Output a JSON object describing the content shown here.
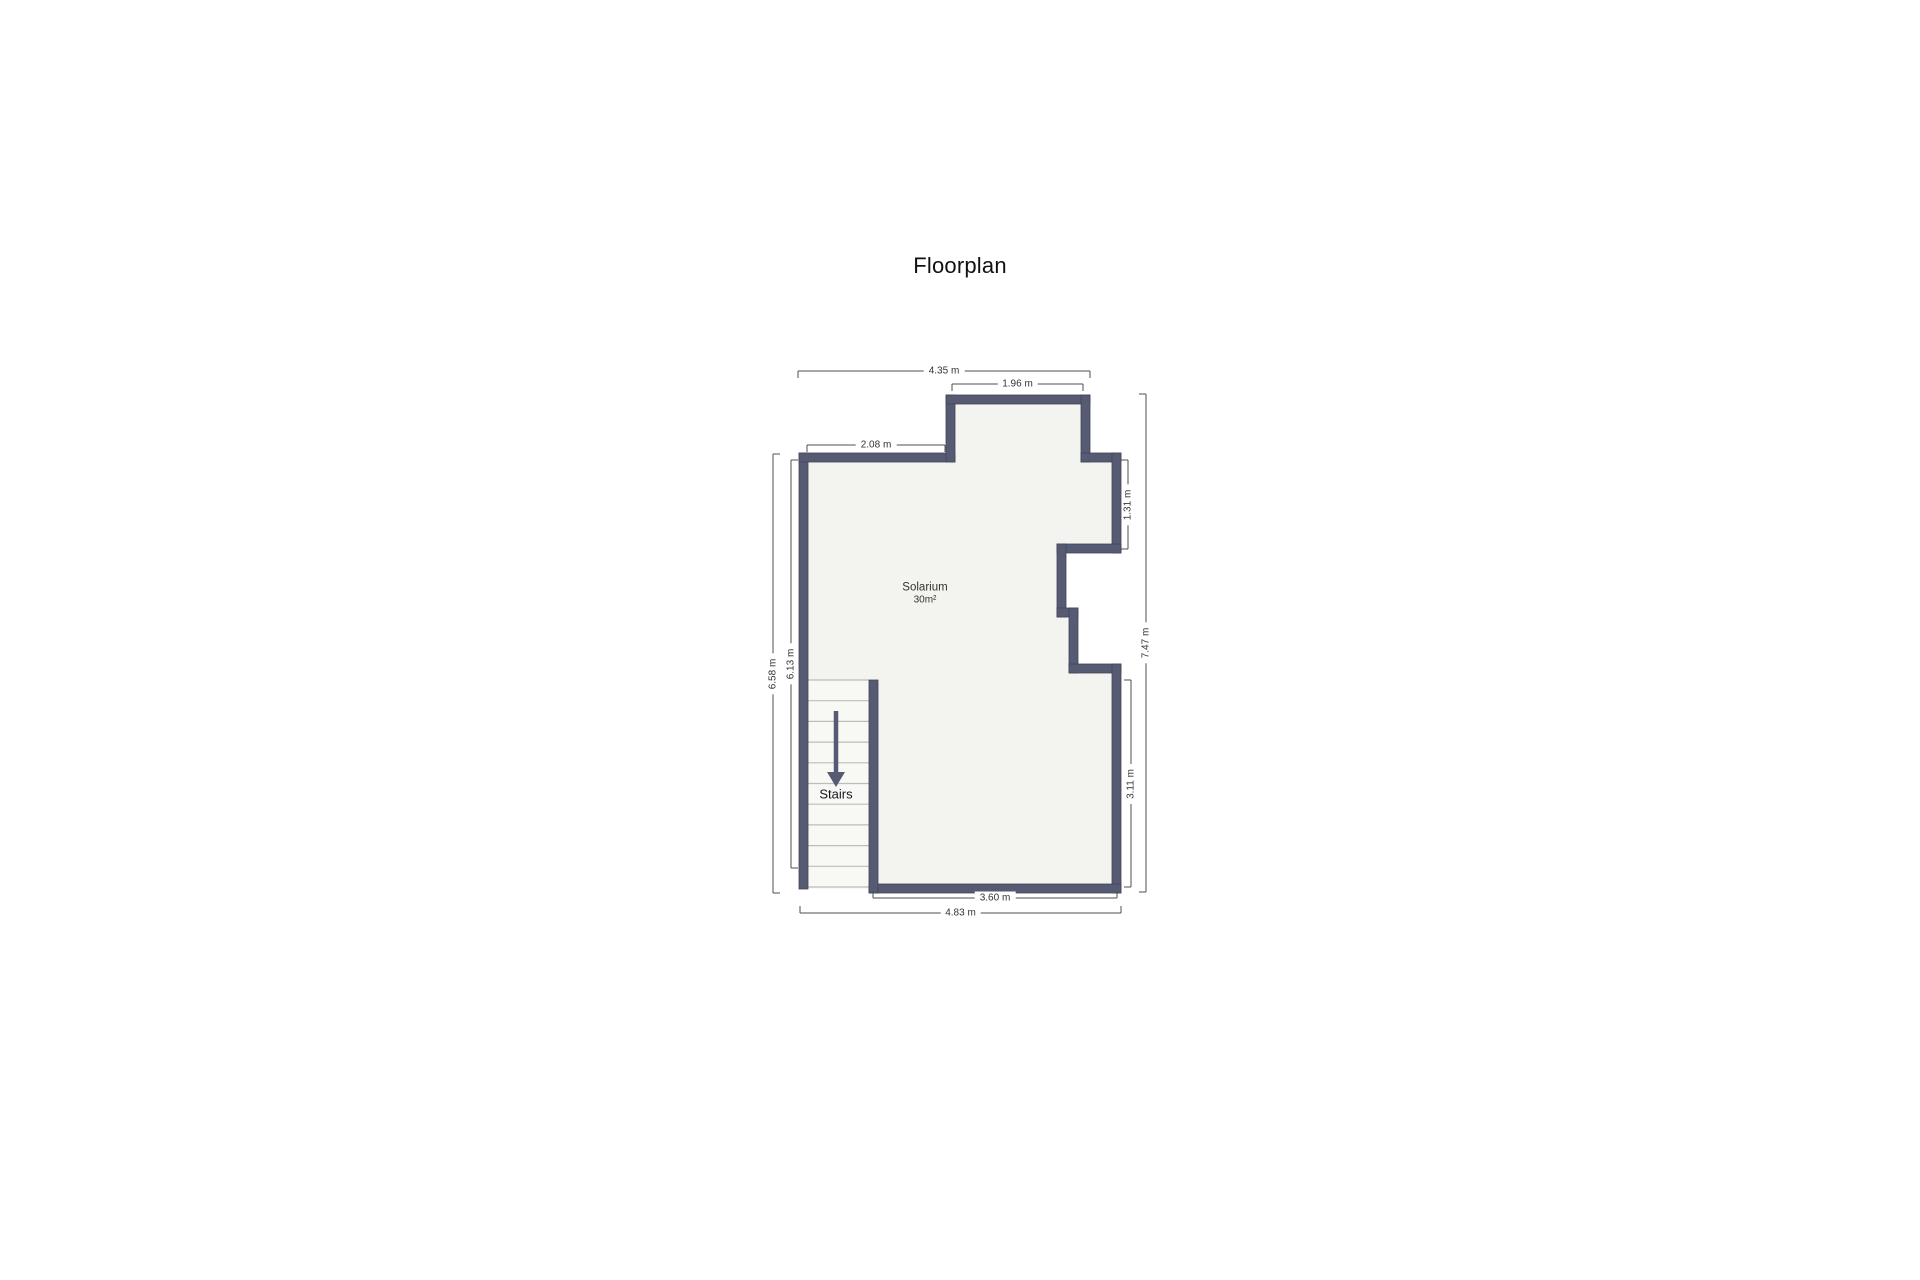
{
  "page": {
    "title": "Floorplan",
    "background": "#ffffff"
  },
  "room": {
    "name": "Solarium",
    "area": "30m²"
  },
  "stairs": {
    "label": "Stairs"
  },
  "colors": {
    "wall": "#565b73",
    "wall_outline": "#41465a",
    "floor": "#f3f3f0",
    "stairwell": "#f8f8f5",
    "tread": "#bcbcbc",
    "dim_line": "#4f4f4f",
    "arrow": "#565b73"
  },
  "floorplan": {
    "floor_polygon": "799,453 946,453 946,395 1090,395 1090,453 1121,453 1121,553 1066,553 1066,608 1078,608 1078,664 1121,664 1121,893 869,893 869,889 799,889",
    "stairwell_rect": {
      "x": 808,
      "y": 680,
      "w": 61,
      "h": 209
    },
    "walls": [
      {
        "name": "wall-left",
        "x": 799,
        "y": 453,
        "w": 9,
        "h": 436
      },
      {
        "name": "wall-top",
        "x": 799,
        "y": 453,
        "w": 156,
        "h": 9
      },
      {
        "name": "wall-bump-left",
        "x": 946,
        "y": 395,
        "w": 9,
        "h": 67
      },
      {
        "name": "wall-bump-top",
        "x": 946,
        "y": 395,
        "w": 144,
        "h": 9
      },
      {
        "name": "wall-bump-right",
        "x": 1081,
        "y": 395,
        "w": 9,
        "h": 67
      },
      {
        "name": "wall-top-right-step",
        "x": 1081,
        "y": 453,
        "w": 40,
        "h": 9
      },
      {
        "name": "wall-right-upper",
        "x": 1112,
        "y": 453,
        "w": 9,
        "h": 100
      },
      {
        "name": "wall-notch-top",
        "x": 1057,
        "y": 544,
        "w": 64,
        "h": 9
      },
      {
        "name": "wall-notch-left-upper",
        "x": 1057,
        "y": 544,
        "w": 9,
        "h": 73
      },
      {
        "name": "wall-notch-step",
        "x": 1057,
        "y": 608,
        "w": 21,
        "h": 9
      },
      {
        "name": "wall-notch-left-lower",
        "x": 1069,
        "y": 608,
        "w": 9,
        "h": 65
      },
      {
        "name": "wall-notch-bottom",
        "x": 1069,
        "y": 664,
        "w": 52,
        "h": 9
      },
      {
        "name": "wall-right-lower",
        "x": 1112,
        "y": 664,
        "w": 9,
        "h": 229
      },
      {
        "name": "wall-bottom",
        "x": 869,
        "y": 884,
        "w": 252,
        "h": 9
      },
      {
        "name": "wall-stairs-right",
        "x": 869,
        "y": 680,
        "w": 9,
        "h": 213
      }
    ],
    "treads": {
      "x1": 808,
      "x2": 869,
      "y_start": 680,
      "y_end": 887,
      "lines": 11
    },
    "arrow": {
      "x": 836,
      "y1": 711,
      "y2": 773,
      "head_half_w": 9,
      "head_len": 14,
      "stroke_w": 4.5
    },
    "room_label_pos": {
      "x": 925,
      "y": 594
    },
    "stairs_label_pos": {
      "x": 836,
      "y": 794
    },
    "dimensions": [
      {
        "label": "4.35 m",
        "orient": "h",
        "x1": 798,
        "x2": 1090,
        "y": 371,
        "tick": "down"
      },
      {
        "label": "1.96 m",
        "orient": "h",
        "x1": 952,
        "x2": 1083,
        "y": 384,
        "tick": "down"
      },
      {
        "label": "2.08 m",
        "orient": "h",
        "x1": 807,
        "x2": 945,
        "y": 445,
        "tick": "down"
      },
      {
        "label": "3.60 m",
        "orient": "h",
        "x1": 873,
        "x2": 1117,
        "y": 898,
        "tick": "up"
      },
      {
        "label": "4.83 m",
        "orient": "h",
        "x1": 800,
        "x2": 1121,
        "y": 913,
        "tick": "up"
      },
      {
        "label": "6.58 m",
        "orient": "v",
        "x": 773,
        "y1": 454,
        "y2": 893,
        "tick": "right"
      },
      {
        "label": "6.13 m",
        "orient": "v",
        "x": 791,
        "y1": 460,
        "y2": 868,
        "tick": "right"
      },
      {
        "label": "1.31 m",
        "orient": "v",
        "x": 1128,
        "y1": 460,
        "y2": 549,
        "tick": "left"
      },
      {
        "label": "7.47 m",
        "orient": "v",
        "x": 1146,
        "y1": 394,
        "y2": 892,
        "tick": "left"
      },
      {
        "label": "3.11 m",
        "orient": "v",
        "x": 1131,
        "y1": 680,
        "y2": 887,
        "tick": "left"
      }
    ]
  }
}
